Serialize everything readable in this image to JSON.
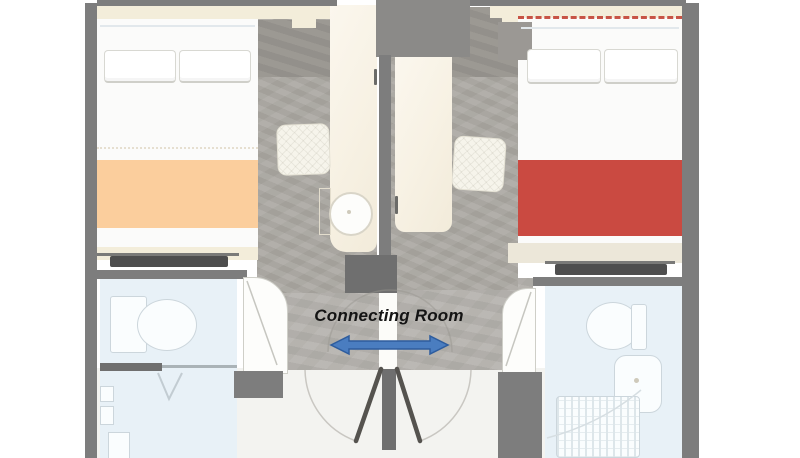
{
  "floorplan": {
    "connecting_label": "Connecting Room",
    "annotation": {
      "arrow_icon": "double-headed-horizontal-arrow",
      "arrow_direction": "left-right"
    },
    "colors": {
      "wall": "#7d7d7d",
      "wall_dark": "#6f6f6f",
      "wall_mid": "#8b8a88",
      "floor_gray": "#aba8a2",
      "floor_entry": "#98958f",
      "corridor_band": "#b5b2ad",
      "bathroom_floor": "#e8f1f7",
      "light_floor": "#f3f3f0",
      "bed_sheet": "#fbfbfa",
      "headboard": "#f3edda",
      "blanket_left": "#fbce9d",
      "blanket_right": "#ca4a41",
      "red_dash": "#c0392b",
      "furniture_dark": "#4e4e4e",
      "fixture_line": "#ccd6dc",
      "arrow_fill": "#4a7dc0",
      "arrow_stroke": "#2e5d9e"
    },
    "rooms": {
      "left": {
        "bed_blanket_color": "#fbce9d",
        "fixtures": [
          "bed",
          "pillows",
          "tv-console",
          "lounge-chair",
          "vanity-counter",
          "round-sink",
          "toilet",
          "shower",
          "entry-door"
        ]
      },
      "right": {
        "bed_blanket_color": "#ca4a41",
        "fixtures": [
          "bed",
          "pillows",
          "tv-console",
          "lounge-chair",
          "desk-closet",
          "toilet",
          "sink",
          "shower-tray",
          "entry-door"
        ]
      }
    }
  }
}
